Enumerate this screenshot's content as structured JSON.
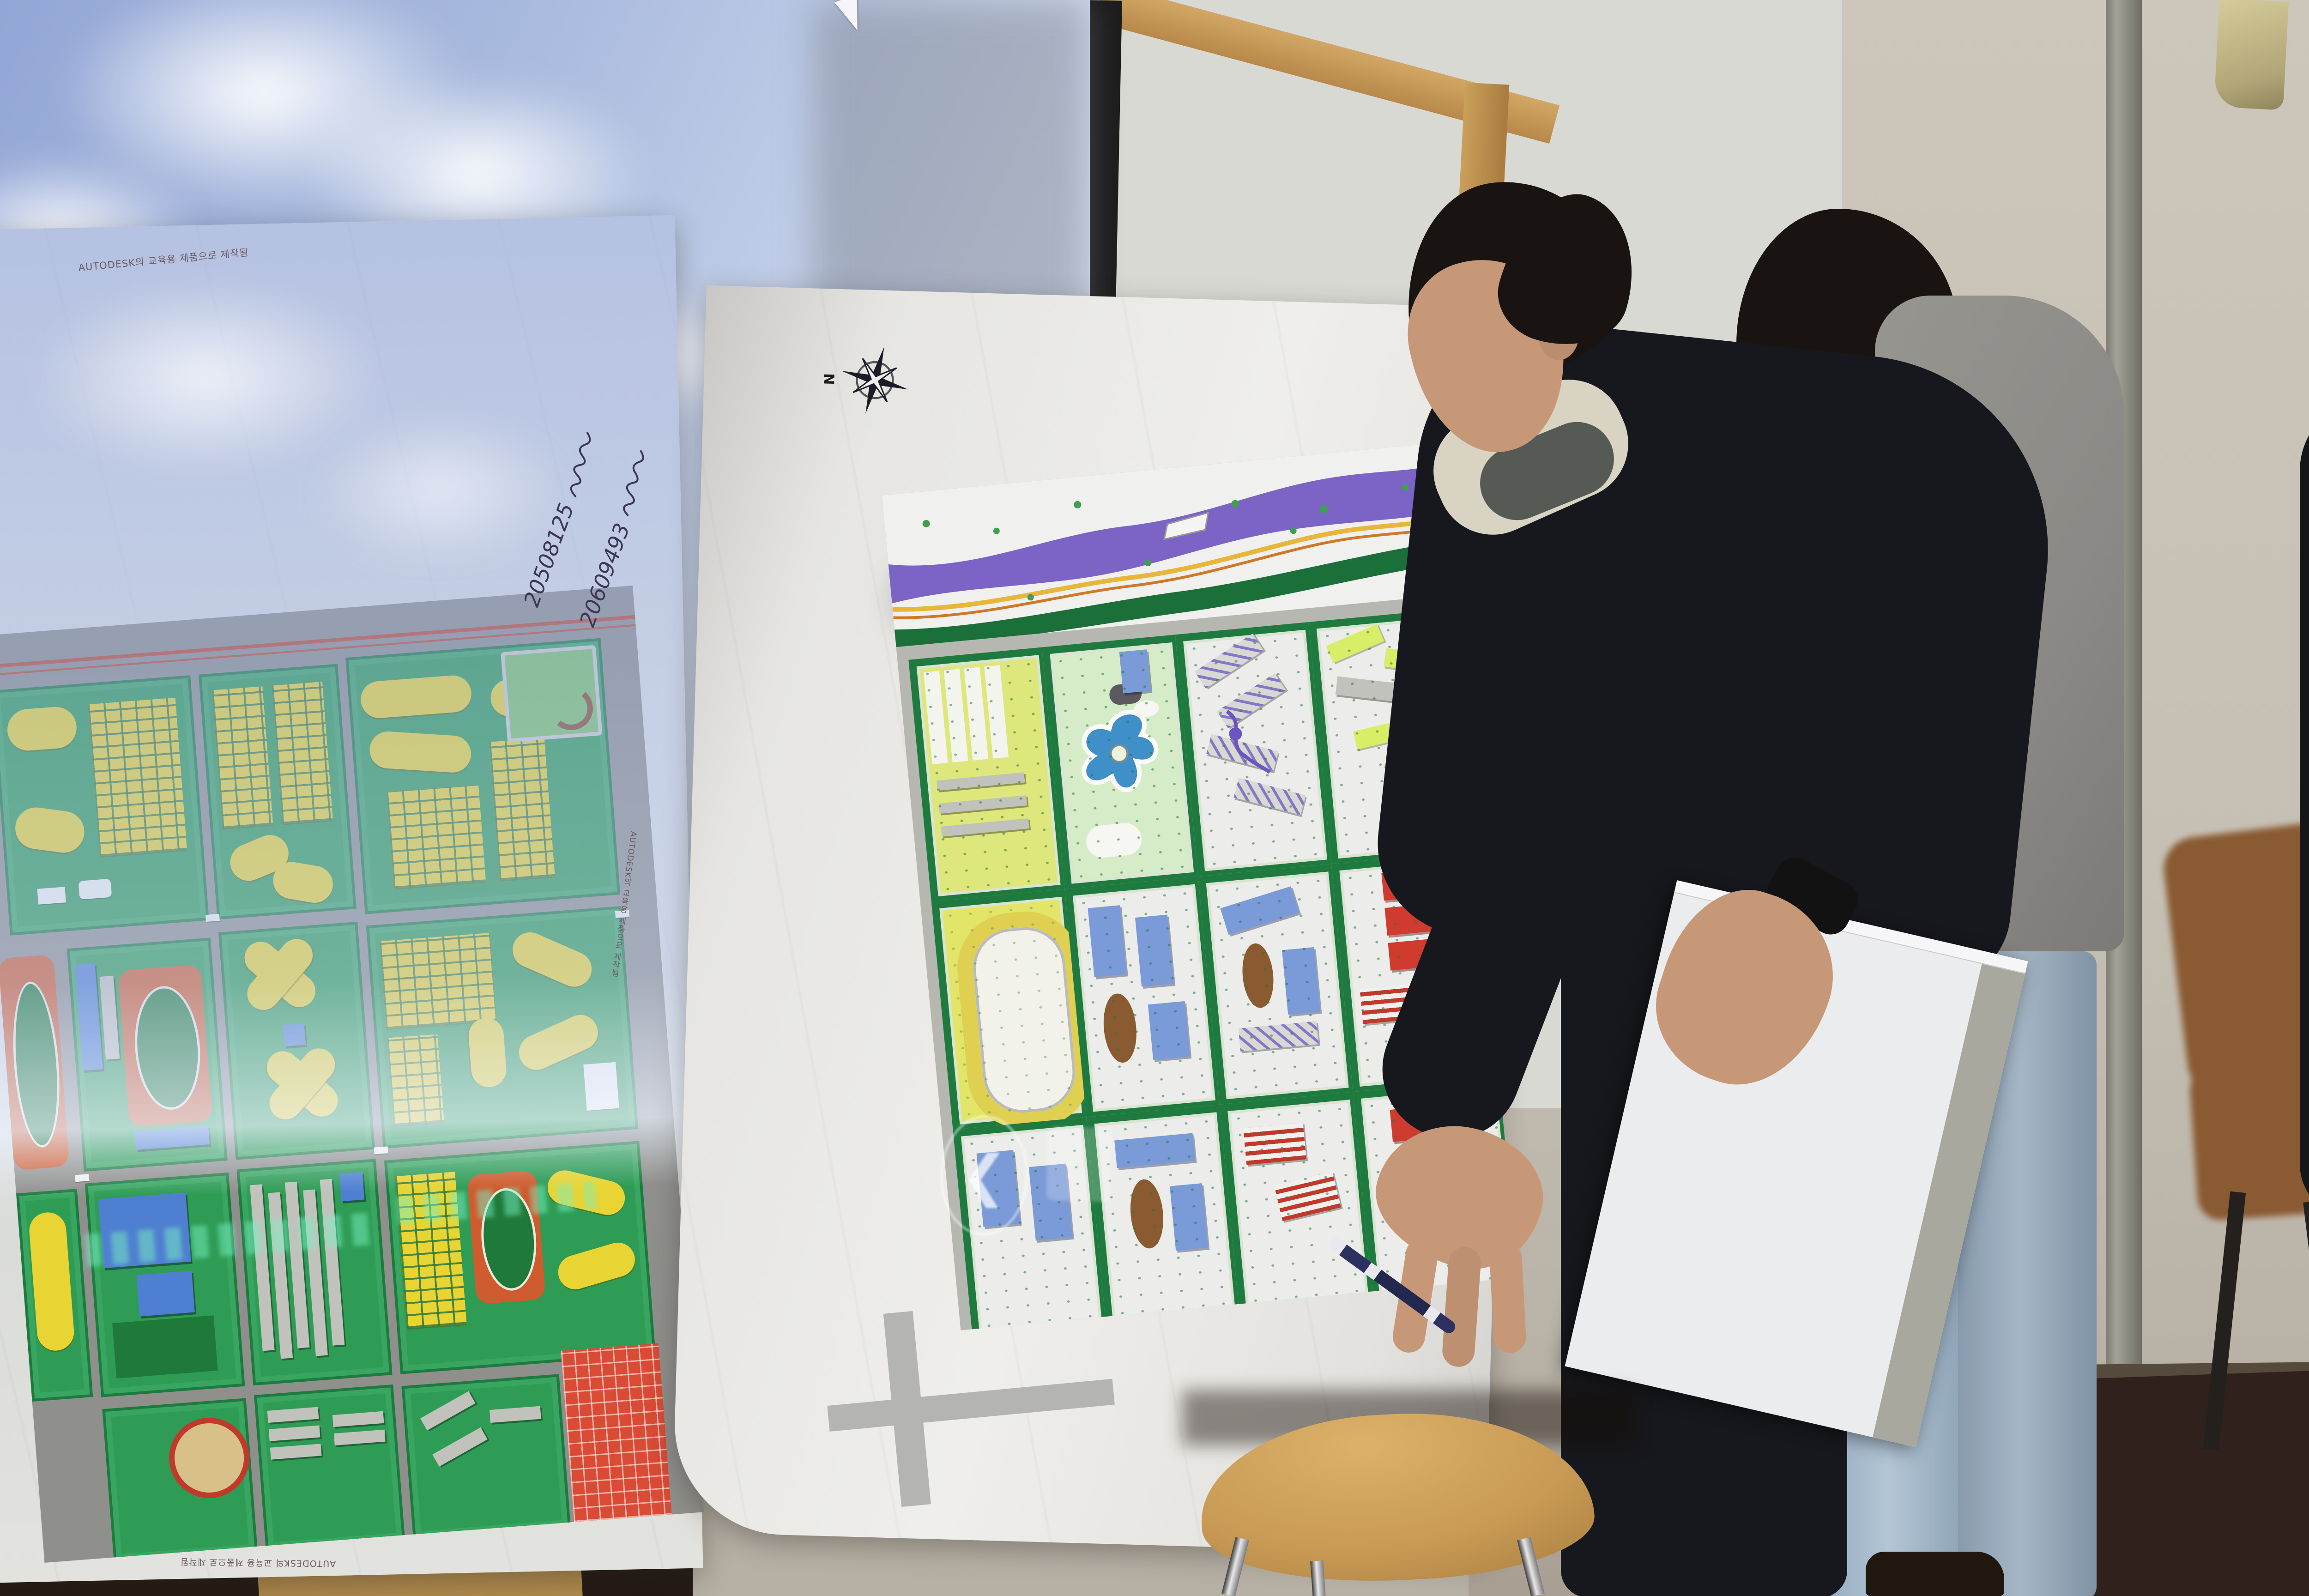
{
  "scene": {
    "description": "Classroom photo: a student presenter points with a pen at a large urban-planning poster while a projector casts a blue sky image, a mouse cursor and a faded previous-slide button over the screen and posters.",
    "setting": "classroom with whiteboard, projection screen, two design posters, wooden stool and chair"
  },
  "projection": {
    "sky_color": "#92a6d6",
    "cloud_color": "#ffffff",
    "cursor_icon": "mouse-arrow",
    "prev_button_chevron": "❮"
  },
  "left_poster": {
    "edu_stamp": "AUTODESK의 교육용 제품으로 제작됨",
    "handwritten_ids": [
      "20508125",
      "20609493"
    ],
    "map_palette": {
      "roads": "#8f8f8c",
      "parkland": "#2e9c55",
      "housing_yellow": "#e8d433",
      "track_orange": "#cf5c2e",
      "civic_blue": "#4f7fd0",
      "commercial_red": "#d94b35"
    }
  },
  "right_poster": {
    "scale_label": "SCALE  1/2000",
    "compass_north": "N",
    "scalebar_ticks": [
      "0",
      "100",
      "250",
      "500M"
    ],
    "map_palette": {
      "river_purple": "#7b64c6",
      "greenbelt": "#1b6f38",
      "lake_blue": "#3f8fc8",
      "block_white": "#ececea",
      "red_blocks": "#cf3b2e",
      "yellow_blocks": "#e3e568"
    }
  },
  "people": {
    "presenter": {
      "jacket_color": "#17181d",
      "holding": "pen and white binder"
    },
    "assistant": {
      "jacket_color": "#8e8c88",
      "jeans_color": "#a9bccb"
    },
    "observer": {
      "jacket_color": "#14161a"
    }
  },
  "furniture": {
    "stool_wood": "#c89a55",
    "chair_wood": "#8a5a32"
  },
  "room": {
    "wall": "#c2bcb0",
    "whiteboard_frame": "#c09550",
    "floor": "#32241e"
  }
}
